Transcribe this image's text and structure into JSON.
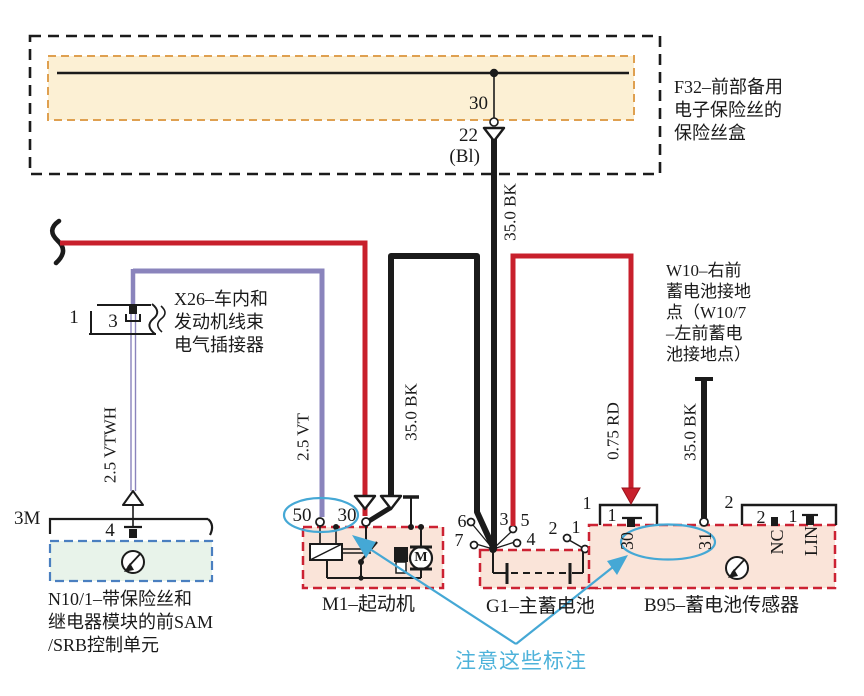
{
  "colors": {
    "wire_red": "#c8202c",
    "wire_violet": "#8a84bc",
    "wire_black": "#1b1b1b",
    "bus_fill": "#fcf0d4",
    "bus_border": "#dfa050",
    "module_fill": "#fae4d9",
    "module_border": "#cc2233",
    "sam_fill": "#e8f3ea",
    "sam_border": "#4a7fc0",
    "annotation_blue": "#45a8d5"
  },
  "fuse_box": {
    "label_lines": [
      "F32–前部备用",
      "电子保险丝的",
      "保险丝盒"
    ],
    "terminal": "30",
    "fuse": "22",
    "fuse_code": "(Bl)"
  },
  "wire_labels": {
    "vtwh": "2.5 VTWH",
    "vt": "2.5 VT",
    "bk_branch": "35.0 BK",
    "bk_main": "35.0 BK",
    "rd": "0.75 RD",
    "bk_ground": "35.0 BK"
  },
  "x26": {
    "pin_outer": "1",
    "pin_inner": "3",
    "label_lines": [
      "X26–车内和",
      "发动机线束",
      "电气插接器"
    ]
  },
  "sam": {
    "bracket_label": "3M",
    "pin": "4",
    "label_lines": [
      "N10/1–带保险丝和",
      "继电器模块的前SAM",
      "/SRB控制单元"
    ]
  },
  "m1": {
    "terminal_50": "50",
    "terminal_30": "30",
    "motor": "M",
    "label": "M1–起动机"
  },
  "g1": {
    "pins": [
      "6",
      "7",
      "3",
      "5",
      "4",
      "2",
      "1"
    ],
    "label": "G1–主蓄电池"
  },
  "b95": {
    "conn1_label": "1",
    "conn1_pin": "1",
    "conn2_label": "2",
    "conn2_pin_a": "2",
    "conn2_pin_b": "1",
    "term_30": "30",
    "term_31": "31",
    "term_nc": "NC",
    "term_lin": "LIN",
    "label": "B95–蓄电池传感器"
  },
  "w10": {
    "label_lines": [
      "W10–右前",
      "蓄电池接地",
      "点（W10/7",
      "–左前蓄电",
      "池接地点）"
    ]
  },
  "note": {
    "text": "注意这些标注"
  }
}
